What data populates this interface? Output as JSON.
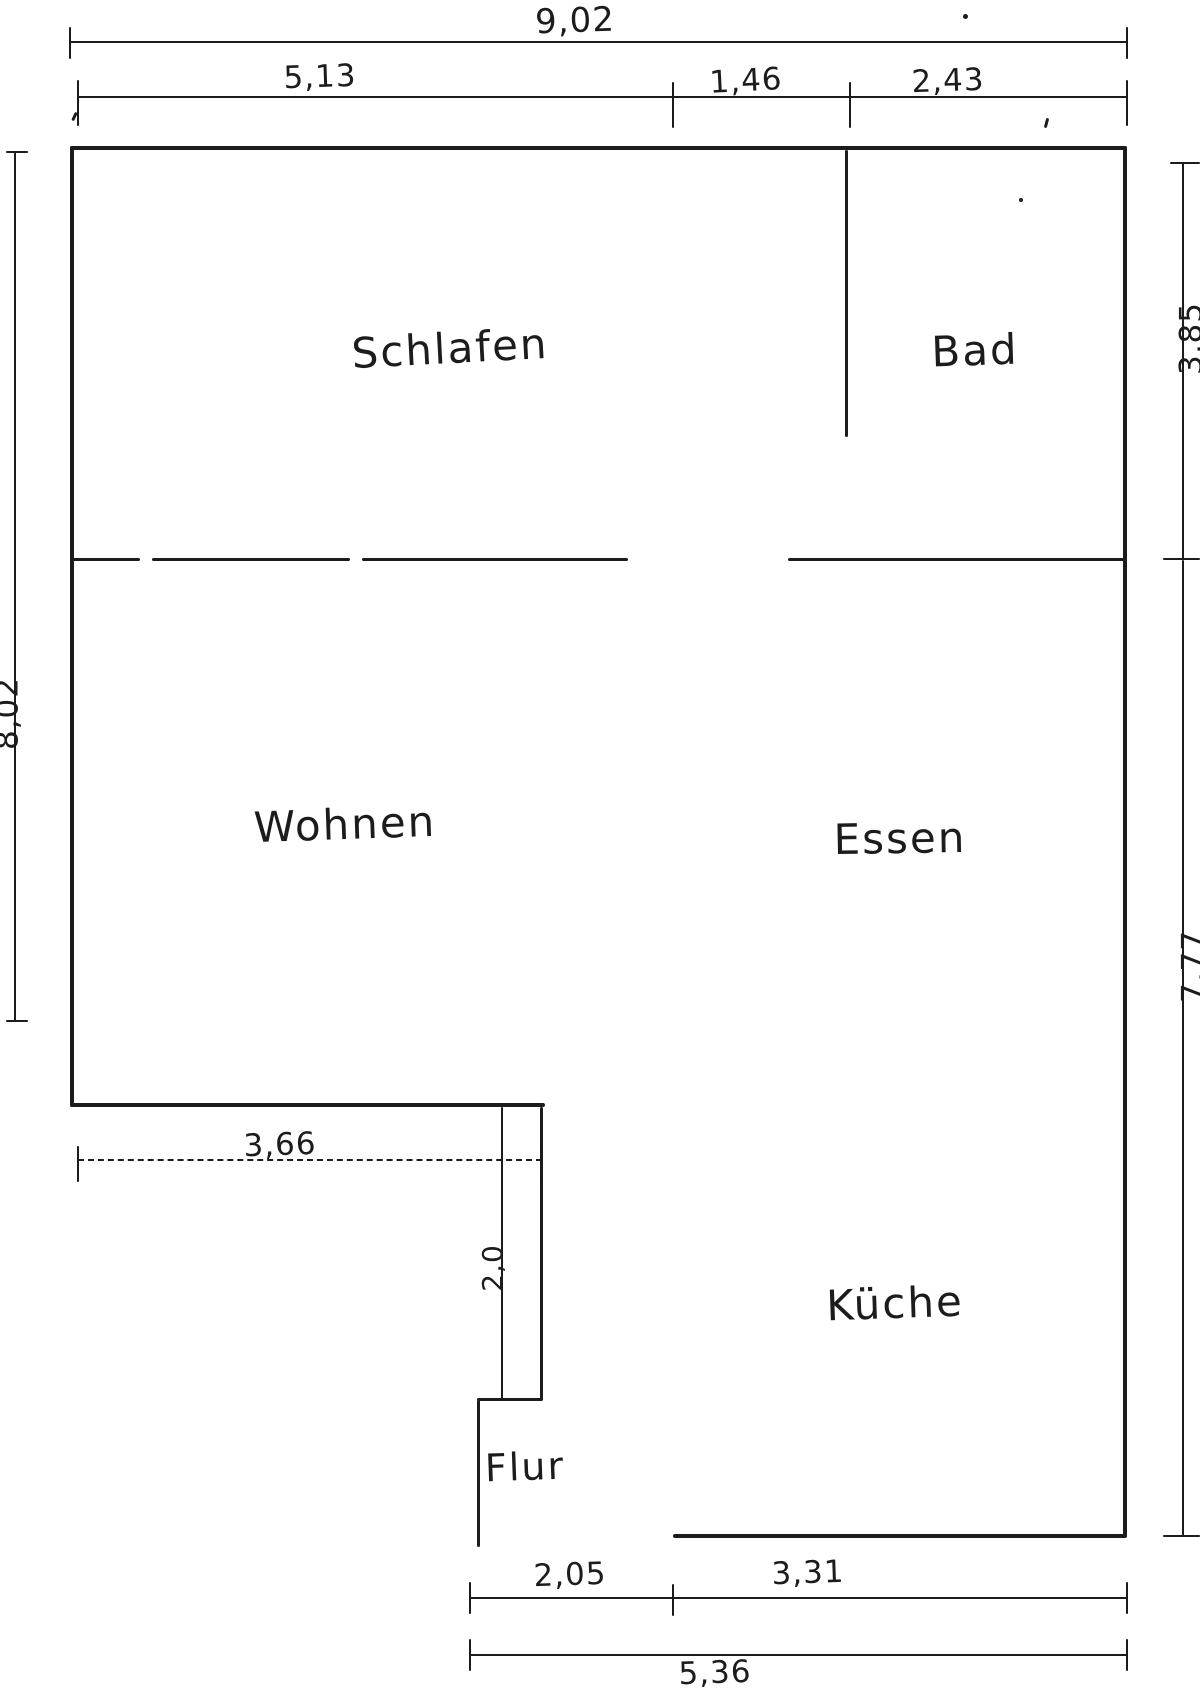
{
  "floorplan": {
    "title": "hand-drawn apartment floor plan",
    "rooms": {
      "schlafen": "Schlafen",
      "bad": "Bad",
      "wohnen": "Wohnen",
      "essen": "Essen",
      "kueche": "Küche",
      "flur": "Flur"
    },
    "dimensions": {
      "top_total": "9,02",
      "top_left": "5,13",
      "top_mid": "1,46",
      "top_right": "2,43",
      "left_total": "8,02",
      "right_upper": "3,85",
      "right_lower": "7,77",
      "mid_width": "3,66",
      "corridor_width": "2,0",
      "bottom_left": "2,05",
      "bottom_right": "3,31",
      "bottom_total": "5,36"
    },
    "colors": {
      "ink": "#1c1c1c",
      "paper": "#ffffff"
    }
  }
}
